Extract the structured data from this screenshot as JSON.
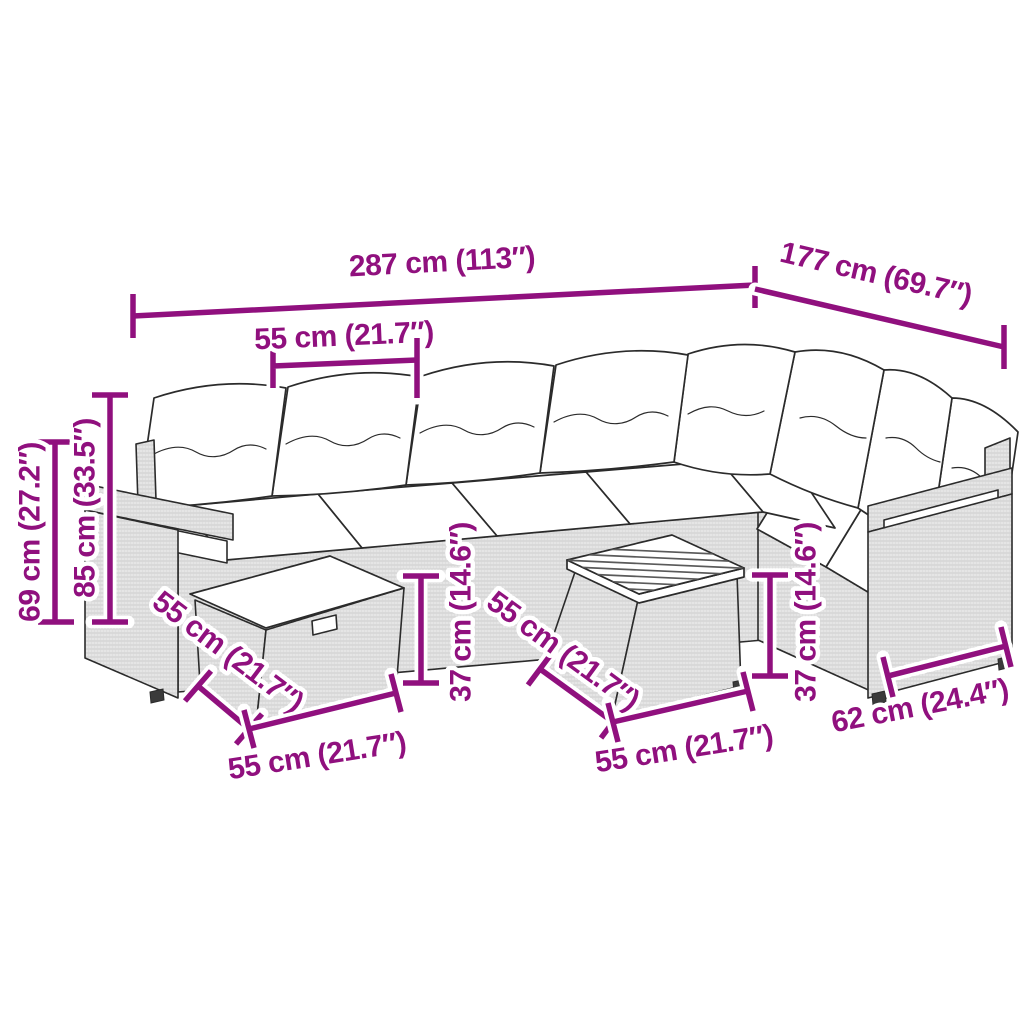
{
  "scene": {
    "description": "Line drawing of an L-shaped poly rattan garden sofa set with white cushions, a storage ottoman and a square coffee table with slatted wood top, annotated with magenta dimension lines"
  },
  "colors": {
    "accent": "#90107E",
    "ink": "#2B2B2B",
    "wood": "#5A5A5A",
    "halo": "#FFFFFF"
  },
  "dimensions": {
    "overall_width": "287 cm (113″)",
    "overall_depth": "177 cm (69.7″)",
    "seat_module_width": "55 cm (21.7″)",
    "arm_height": "69 cm (27.2″)",
    "back_height": "85 cm (33.5″)",
    "seat_height_front": "37 cm (14.6″)",
    "seat_height_right": "37 cm (14.6″)",
    "ottoman_depth": "55 cm (21.7″)",
    "ottoman_width": "55 cm (21.7″)",
    "table_depth": "55 cm (21.7″)",
    "table_width": "55 cm (21.7″)",
    "end_seat_width": "62 cm (24.4″)"
  }
}
